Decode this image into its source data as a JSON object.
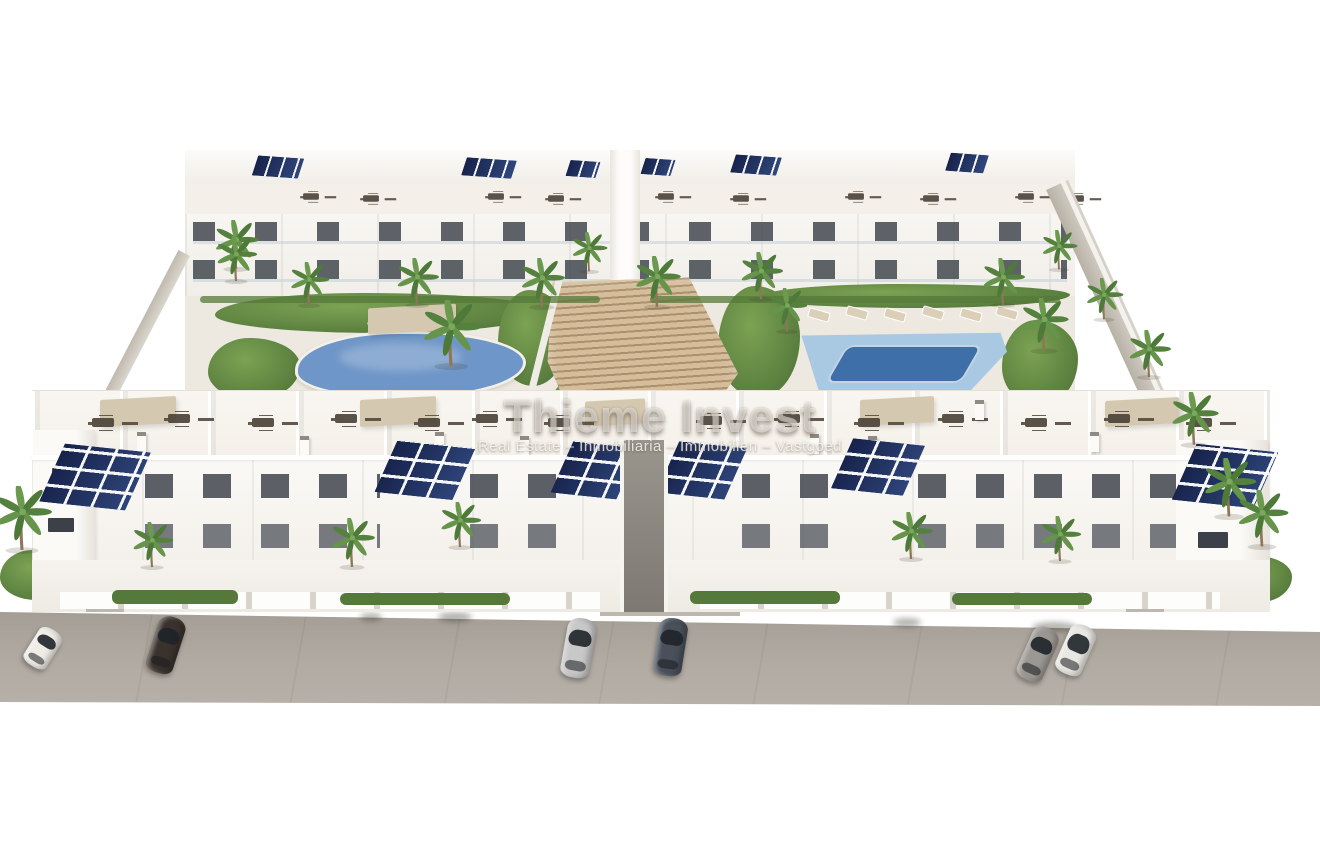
{
  "watermark": {
    "title": "Thieme Invest",
    "subtitle": "Real Estate – Inmobiliaria – Immobilien – Vastgoed"
  },
  "colors": {
    "background": "#ffffff",
    "building_white": "#f7f5f1",
    "facade_shadow": "#e3dfd8",
    "window_dark": "#3c4149",
    "solar_panel_navy": "#1f2c4e",
    "roof_terrace_cream": "#f3efe8",
    "pergola_tan": "#d5c8b0",
    "furniture_brown": "#4a4138",
    "stairs_wood_tan": "#c3a98a",
    "garden_green": "#6b8f45",
    "hedge_dark_green": "#55793a",
    "palm_green": "#5d8a46",
    "palm_trunk": "#8d7758",
    "pool_left_water": "#6f96c8",
    "pool_right_shallow": "#a9c9e2",
    "pool_right_deep": "#3f6fa8",
    "deck_cream": "#eee9e0",
    "street_gray": "#ada69d",
    "wall_beige": "#c6c0b6"
  },
  "cars": [
    {
      "name": "white sedan far left",
      "color": "#efece6"
    },
    {
      "name": "dark brown sedan left",
      "color": "#3a322c"
    },
    {
      "name": "silver suv center-left",
      "color": "#c8c8c8"
    },
    {
      "name": "dark gray suv center-right",
      "color": "#49505a"
    },
    {
      "name": "gray suv right pair",
      "color": "#9b9792"
    },
    {
      "name": "white suv right pair",
      "color": "#e9e7e2"
    }
  ],
  "scene": {
    "pools": [
      {
        "name": "left-pool",
        "shape": "organic kidney"
      },
      {
        "name": "right-pool",
        "shape": "rectangular with lap lane"
      }
    ],
    "building_rows": [
      "rear apartment block with balconies",
      "front apartment block with roof terraces"
    ]
  }
}
